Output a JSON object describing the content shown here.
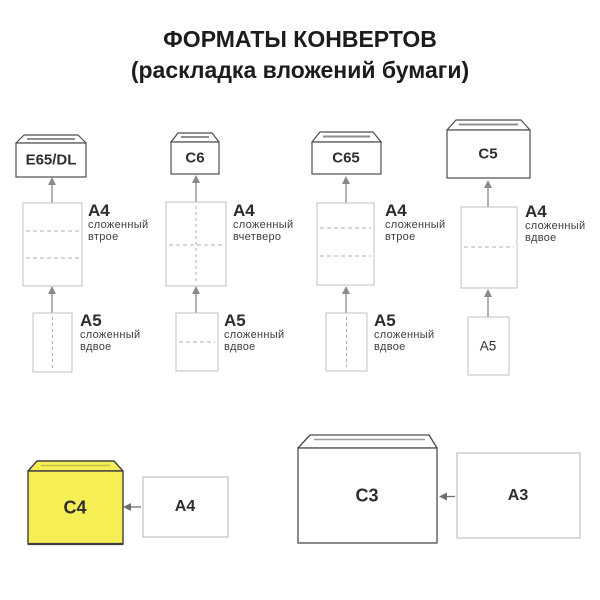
{
  "title": {
    "line1": "ФОРМАТЫ КОНВЕРТОВ",
    "line2": "(раскладка вложений бумаги)"
  },
  "columns": [
    {
      "envelope_label": "E65/DL",
      "a4": {
        "label": "A4",
        "desc_line1": "сложенный",
        "desc_line2": "втрое",
        "fold": "two horizontal dashed fold lines"
      },
      "a5": {
        "label": "A5",
        "desc_line1": "сложенный",
        "desc_line2": "вдвое",
        "fold": "one vertical dashed fold line"
      }
    },
    {
      "envelope_label": "C6",
      "a4": {
        "label": "A4",
        "desc_line1": "сложенный",
        "desc_line2": "вчетверо",
        "fold": "one horizontal and one vertical dashed fold line"
      },
      "a5": {
        "label": "A5",
        "desc_line1": "сложенный",
        "desc_line2": "вдвое",
        "fold": "one horizontal dashed fold line"
      }
    },
    {
      "envelope_label": "C65",
      "a4": {
        "label": "A4",
        "desc_line1": "сложенный",
        "desc_line2": "втрое",
        "fold": "two horizontal dashed fold lines"
      },
      "a5": {
        "label": "A5",
        "desc_line1": "сложенный",
        "desc_line2": "вдвое",
        "fold": "one vertical dashed fold line"
      }
    },
    {
      "envelope_label": "C5",
      "a4": {
        "label": "A4",
        "desc_line1": "сложенный",
        "desc_line2": "вдвое",
        "fold": "one horizontal dashed fold line"
      },
      "a5": {
        "label": "A5",
        "fold": "none, unfolded sheet with label inside"
      }
    }
  ],
  "bottom_row": [
    {
      "envelope_label": "C4",
      "sheet_label": "A4",
      "envelope_fill": "#f5ee55"
    },
    {
      "envelope_label": "C3",
      "sheet_label": "A3",
      "envelope_fill": "#ffffff"
    }
  ],
  "colors": {
    "highlight_yellow": "#f5ee55",
    "envelope_outline": "#4d4d4d",
    "sheet_outline": "#c2c2c2",
    "arrow_gray": "#8a8a8a",
    "text_dark": "#2b2b2b"
  }
}
